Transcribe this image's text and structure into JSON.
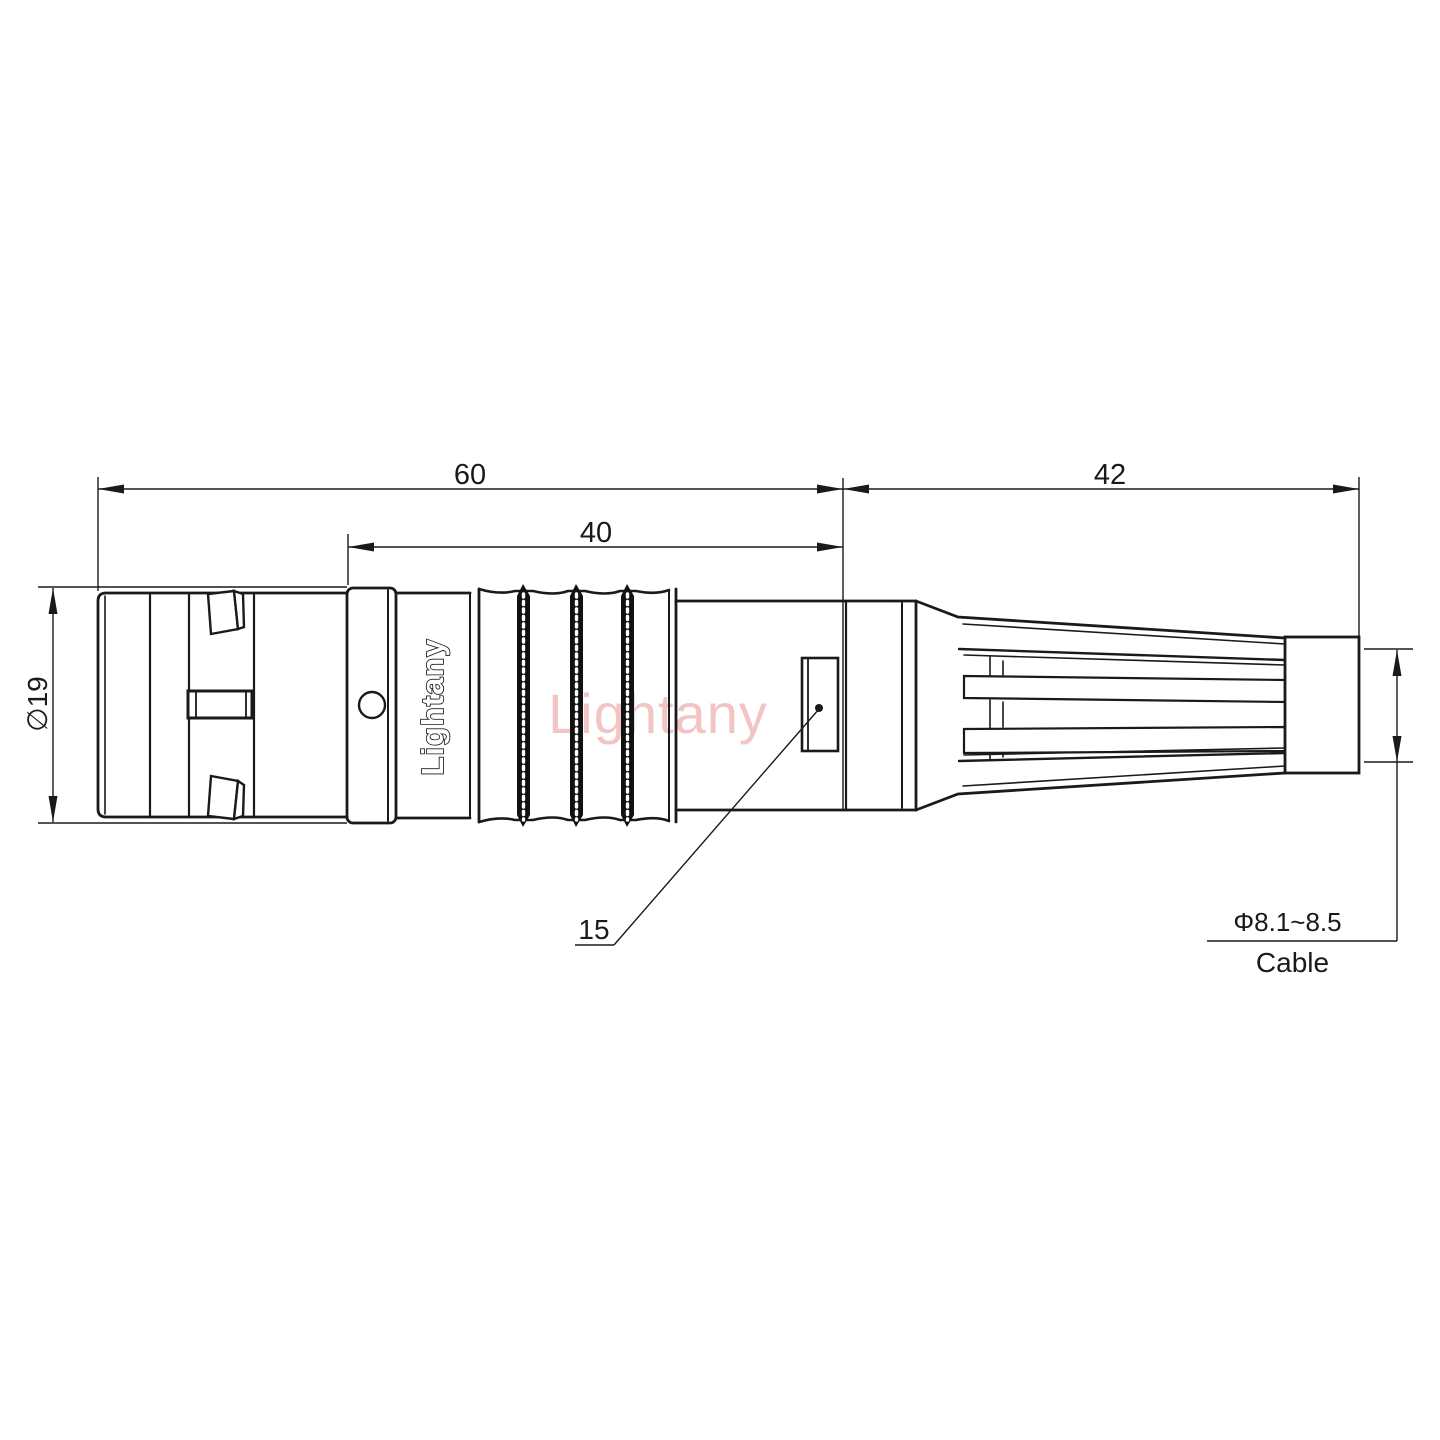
{
  "labels": {
    "dim_total_length": "60",
    "dim_body_length": "40",
    "dim_boot_length": "42",
    "dim_flange_diameter": "∅19",
    "dim_feature": "15",
    "cable_diameter_range": "Φ8.1~8.5",
    "cable_name": "Cable"
  },
  "branding": {
    "body_logo": "Lightany",
    "watermark": "Lightany"
  },
  "colors": {
    "line": "#1a1a1a",
    "watermark_pink": "rgba(220,85,85,0.35)",
    "background": "#ffffff"
  }
}
